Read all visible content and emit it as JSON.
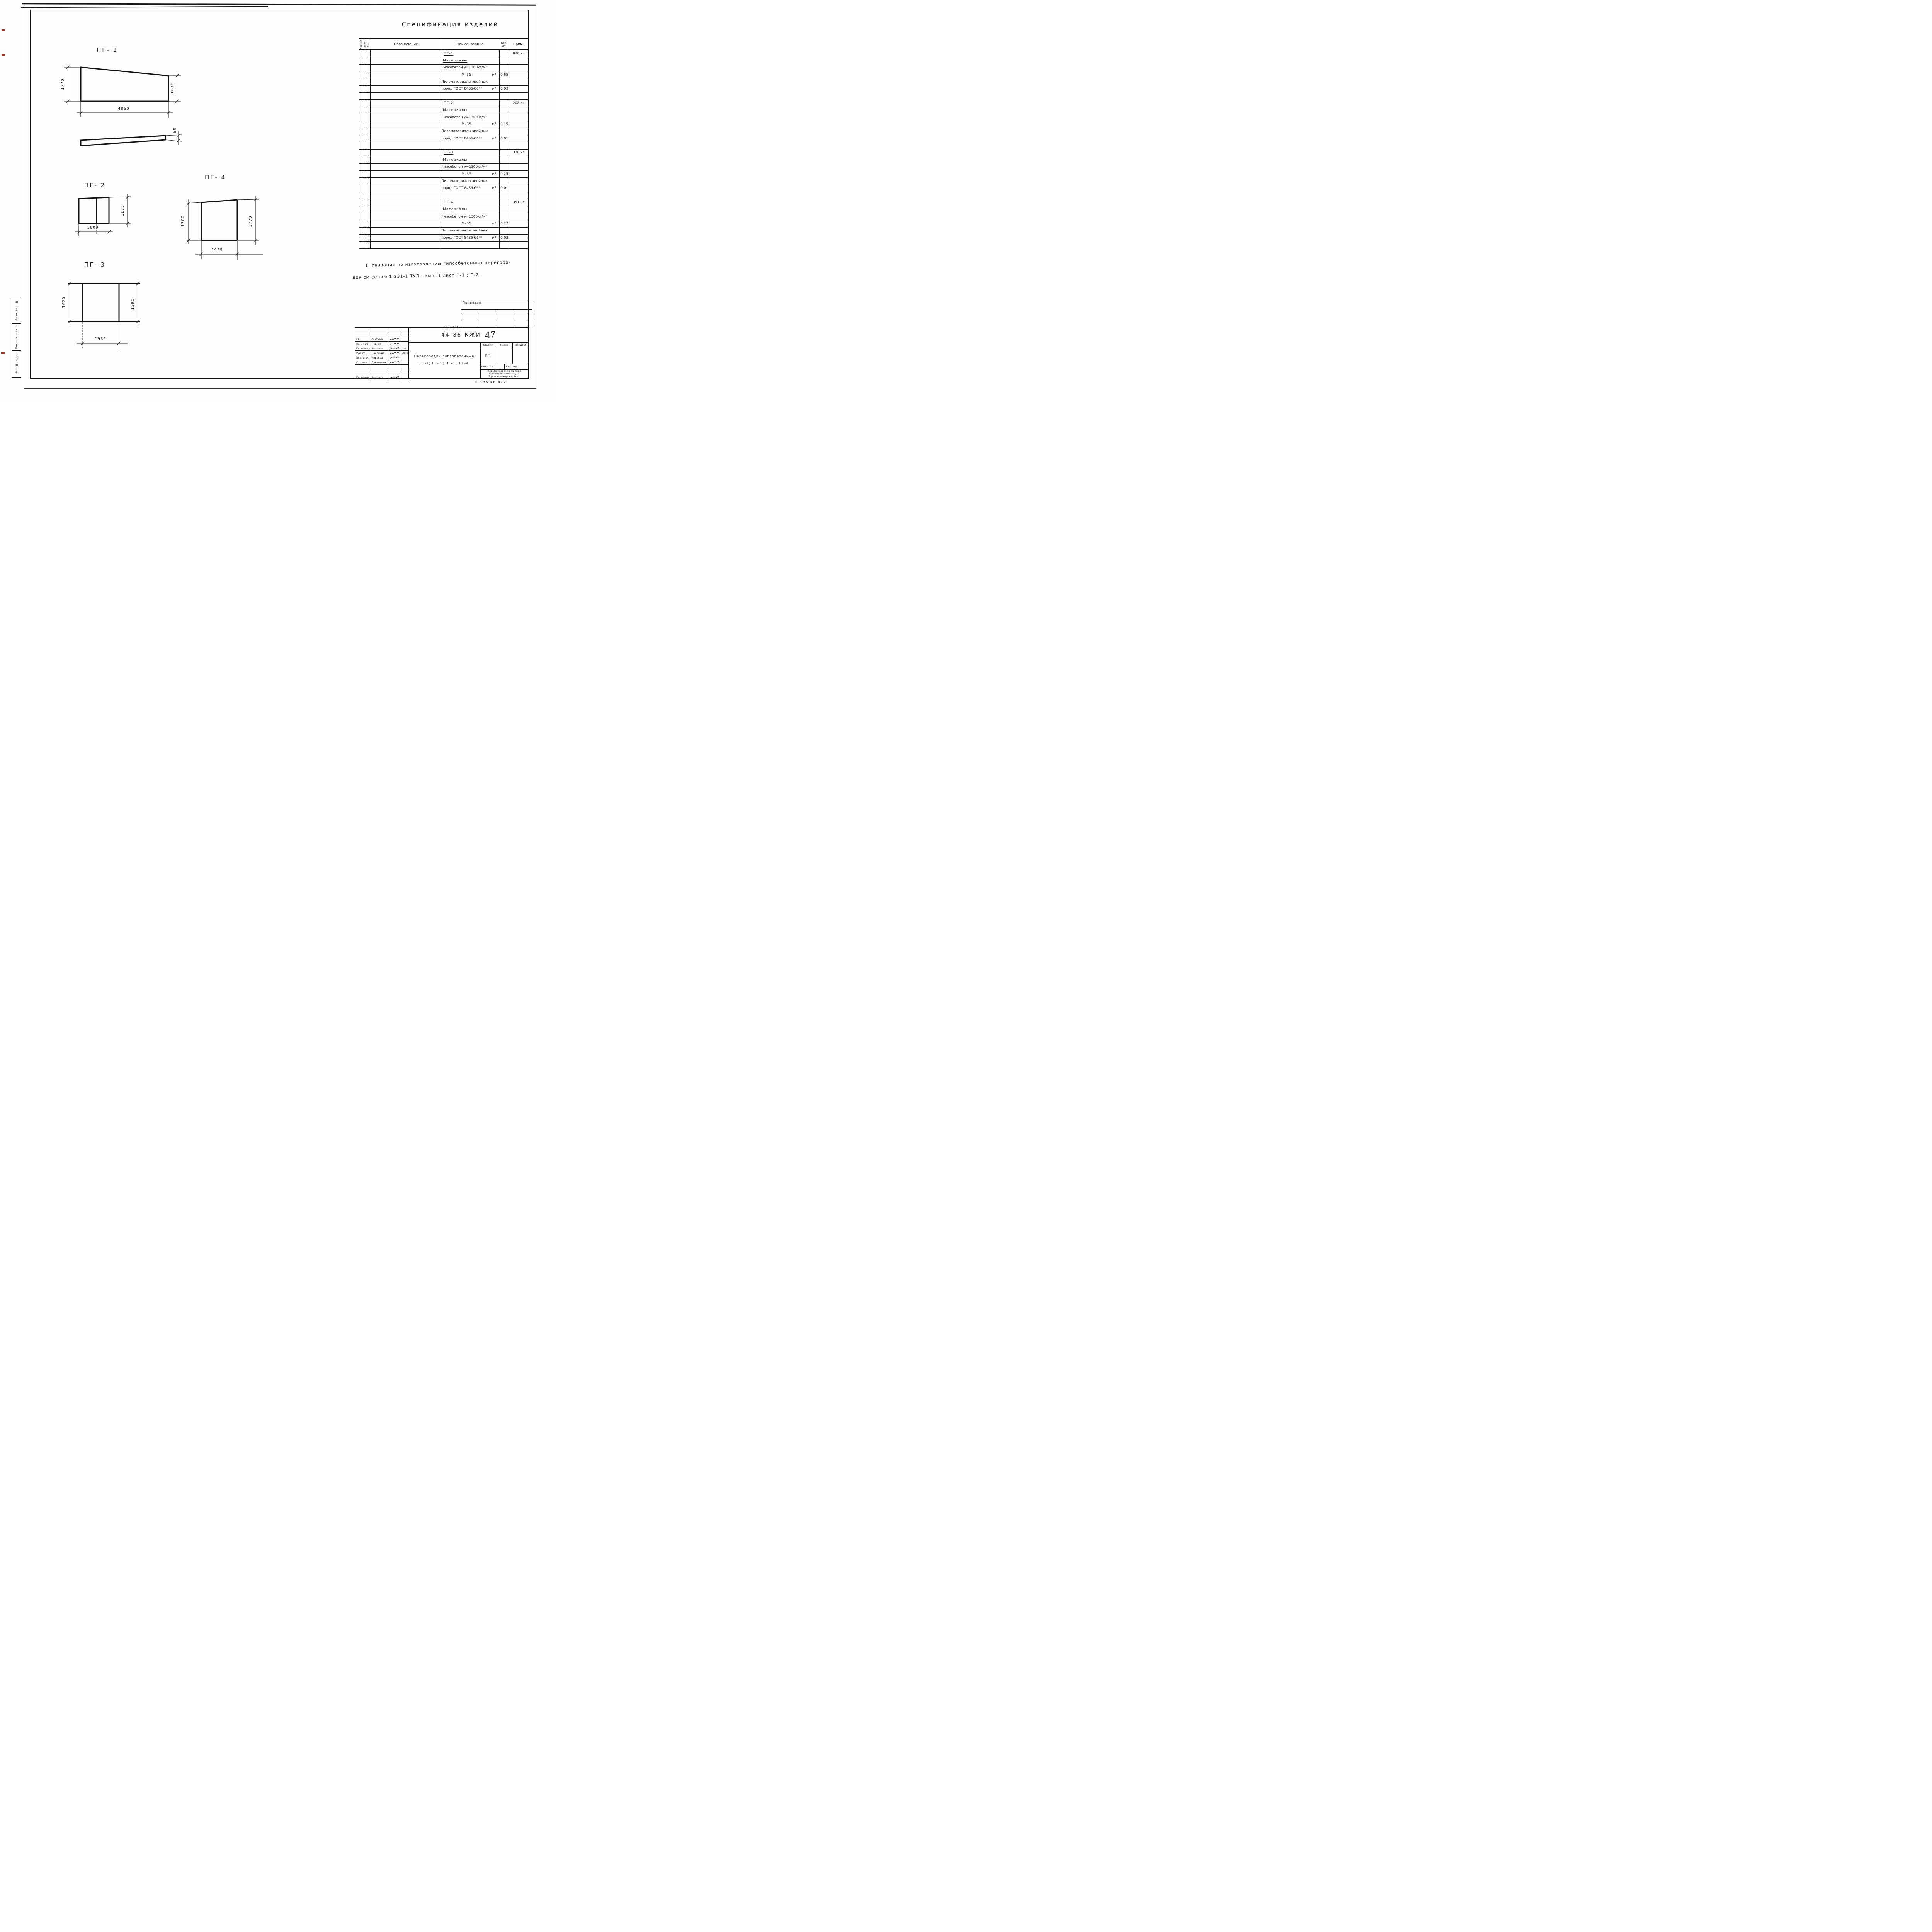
{
  "page": {
    "spec_title": "Спецификация изделий",
    "note_line1": "1. Указания по изготовлению    гипсобетонных перегоро-",
    "note_line2": "док см серию 1.231-1 ТУЛ , вып. 1   лист П-1 ; П-2.",
    "format_note": "Формат А-2",
    "inv_note": "Инв №2"
  },
  "spec_table": {
    "headers": {
      "format": "Формат",
      "zone": "Зона",
      "pos": "Поз.",
      "designation": "Обозначение",
      "name": "Наименование",
      "qty1": "Кол.",
      "qty2": "шт.",
      "note": "Прим."
    },
    "rows": [
      {
        "t": "ПГ-1",
        "cls": "sect",
        "u": "",
        "q": "",
        "p": "878 кг"
      },
      {
        "t": "Материалы",
        "cls": "mat",
        "u": "",
        "q": "",
        "p": ""
      },
      {
        "t": "Гипсобетон γ=1300кг/м³",
        "cls": "plain",
        "u": "",
        "q": "",
        "p": ""
      },
      {
        "t": "М-35",
        "cls": "m35",
        "u": "м³",
        "q": "0,65",
        "p": ""
      },
      {
        "t": "Пиломатериалы хвойных",
        "cls": "plain",
        "u": "",
        "q": "",
        "p": ""
      },
      {
        "t": "пород ГОСТ 8486-66**",
        "cls": "plain",
        "u": "м³",
        "q": "0,03",
        "p": ""
      },
      {
        "t": "",
        "cls": "",
        "u": "",
        "q": "",
        "p": ""
      },
      {
        "t": "ПГ-2",
        "cls": "sect",
        "u": "",
        "q": "",
        "p": "208 кг"
      },
      {
        "t": "Материалы",
        "cls": "mat",
        "u": "",
        "q": "",
        "p": ""
      },
      {
        "t": "Гипсобетон γ=1300кг/м³",
        "cls": "plain",
        "u": "",
        "q": "",
        "p": ""
      },
      {
        "t": "М-35",
        "cls": "m35",
        "u": "м³",
        "q": "0,15",
        "p": ""
      },
      {
        "t": "Пиломатериалы хвойных",
        "cls": "plain",
        "u": "",
        "q": "",
        "p": ""
      },
      {
        "t": "пород ГОСТ 8486-66**",
        "cls": "plain",
        "u": "м³",
        "q": "0,01",
        "p": ""
      },
      {
        "t": "",
        "cls": "",
        "u": "",
        "q": "",
        "p": ""
      },
      {
        "t": "ПГ-3",
        "cls": "sect",
        "u": "",
        "q": "",
        "p": "338 кг"
      },
      {
        "t": "Материалы",
        "cls": "mat",
        "u": "",
        "q": "",
        "p": ""
      },
      {
        "t": "Гипсобетон γ=1300кг/м³",
        "cls": "plain",
        "u": "",
        "q": "",
        "p": ""
      },
      {
        "t": "М-35",
        "cls": "m35",
        "u": "м³",
        "q": "0,25",
        "p": ""
      },
      {
        "t": "Пиломатериалы хвойных",
        "cls": "plain",
        "u": "",
        "q": "",
        "p": ""
      },
      {
        "t": "пород ГОСТ 8486-66*",
        "cls": "plain",
        "u": "м³",
        "q": "0,01",
        "p": ""
      },
      {
        "t": "",
        "cls": "",
        "u": "",
        "q": "",
        "p": ""
      },
      {
        "t": "ПГ-4",
        "cls": "sect",
        "u": "",
        "q": "",
        "p": "351 кг"
      },
      {
        "t": "Материалы",
        "cls": "mat",
        "u": "",
        "q": "",
        "p": ""
      },
      {
        "t": "Гипсобетон γ=1300кг/м³",
        "cls": "plain",
        "u": "",
        "q": "",
        "p": ""
      },
      {
        "t": "М-35",
        "cls": "m35",
        "u": "м³",
        "q": "0,27",
        "p": ""
      },
      {
        "t": "Пиломатериалы хвойных",
        "cls": "plain",
        "u": "",
        "q": "",
        "p": ""
      },
      {
        "t": "пород ГОСТ 8486-66**",
        "cls": "plain",
        "u": "м³",
        "q": "0,02",
        "p": ""
      },
      {
        "t": "",
        "cls": "",
        "u": "",
        "q": "",
        "p": ""
      }
    ]
  },
  "panels": {
    "pg1": {
      "label": "ПГ- 1",
      "left": "1770",
      "right": "1630",
      "bottom": "4860"
    },
    "strip": {
      "thickness": "80"
    },
    "pg2": {
      "label": "ПГ- 2",
      "right": "1170",
      "bottom": "1600"
    },
    "pg3": {
      "label": "ПГ- 3",
      "left": "1620",
      "right": "1590",
      "bottom": "1935"
    },
    "pg4": {
      "label": "ПГ- 4",
      "left": "1700",
      "right": "1770",
      "bottom": "1935"
    }
  },
  "attach_table": {
    "title": "Привязан"
  },
  "title_block": {
    "doc_number": "44-86-КЖИ",
    "sheet_number_hand": "47",
    "title_line1": "Перегородки гипсобетонные",
    "title_line2": "ПГ-1; ПГ-2 ; ПГ-3 , ПГ-4",
    "stage_label": "Стадия",
    "mass_label": "Масса",
    "scale_label": "Масштаб",
    "stage_value": "РП",
    "sheet_label": "Лист 46",
    "sheets_label": "Листов",
    "org_line1": "Новомосковский филиал",
    "org_line2": "проектного института",
    "org_line3": "Тульскгражданпроект",
    "people": [
      {
        "role": "ГАП",
        "name": "Улитина",
        "date": ""
      },
      {
        "role": "Нач. КСО",
        "name": "Левина",
        "date": ""
      },
      {
        "role": "Гл. констр.",
        "name": "Улитина",
        "date": "—"
      },
      {
        "role": "Рук. гр.",
        "name": "Полосина",
        "date": "10.86"
      },
      {
        "role": "Вед. инж.",
        "name": "Киреева",
        "date": ""
      },
      {
        "role": "Ст. техн.",
        "name": "Дуненкова",
        "date": ""
      },
      {
        "role": "Гл. контр.",
        "name": "Улитина",
        "date": ""
      }
    ]
  },
  "side_strip": {
    "cells": [
      "Взам. инв. №",
      "Подпись и дата",
      "Инв. № подл."
    ]
  }
}
